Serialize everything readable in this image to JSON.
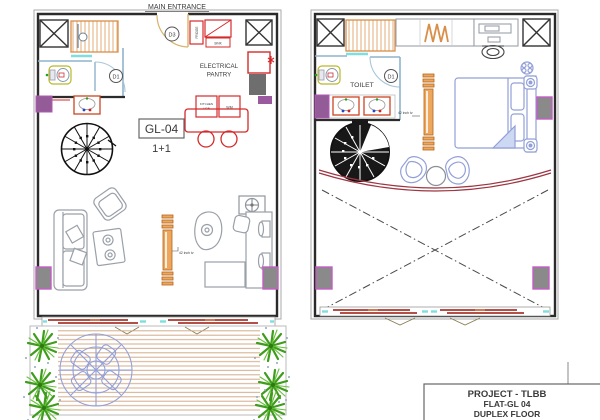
{
  "plan_left": {
    "entrance_label": "MAIN ENTRANCE",
    "unit_code": "GL-04",
    "unit_type": "1+1",
    "pantry_line1": "ELECTRICAL",
    "pantry_line2": "PANTRY",
    "door_d3": "D3",
    "door_d1": "D1",
    "fridge_label": "FRIDGE",
    "sink_label": "SINK",
    "hob_line1": "KITCHEN",
    "hob_line2": "HOB",
    "wm_label": "WM",
    "tv_label": "42 inch tv"
  },
  "plan_right": {
    "toilet_label": "TOILET",
    "door_d1": "D1",
    "tv_label": "42 inch tv"
  },
  "title_block": {
    "project": "PROJECT - TLBB",
    "flat": "FLAT-GL 04",
    "floor": "DUPLEX FLOOR"
  },
  "colors": {
    "wall": "#2b2b2b",
    "interior_wall": "#8fb3cc",
    "column_fill": "#8a8a8a",
    "column_border": "#c45ec4",
    "corner_column": "#935b98",
    "kitchen_red": "#d42a2a",
    "wood_orange": "#d98f4a",
    "furniture_gray": "#9aa0a8",
    "blue_furniture": "#93a0d8",
    "cyan_glass": "#7fdede",
    "deck_plank": "#d3ac8a",
    "window_bar": "#b35048",
    "plant_green": "#3f9c1c",
    "curve_red": "#9c3642",
    "title_red": "#e23a3a"
  }
}
